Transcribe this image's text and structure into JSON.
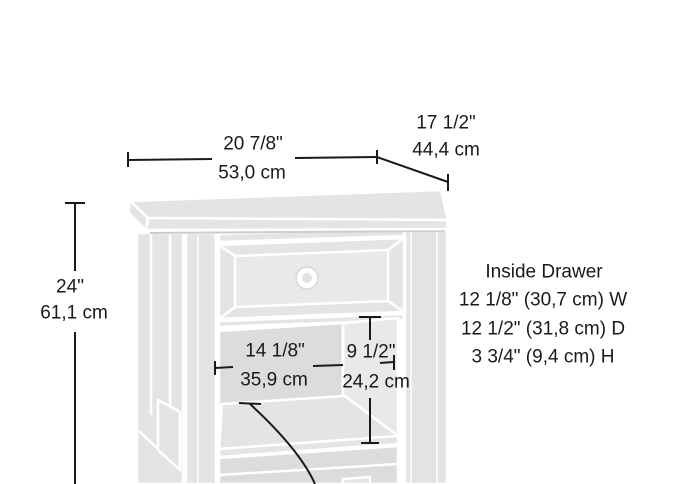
{
  "illustration": {
    "subject": "nightstand line drawing with one drawer and open shelf",
    "colors": {
      "background": "#ffffff",
      "fill": "#e4e4e4",
      "fill_light": "#e9e9e9",
      "fill_shadow": "#dcdcdc",
      "outline": "#ffffff",
      "dimension": "#1a1a1a"
    }
  },
  "dimensions": {
    "width": {
      "imperial": "20 7/8\"",
      "metric": "53,0 cm"
    },
    "depth": {
      "imperial": "17 1/2\"",
      "metric": "44,4 cm"
    },
    "height": {
      "imperial": "24\"",
      "metric": "61,1 cm"
    },
    "shelf_width": {
      "imperial": "14 1/8\"",
      "metric": "35,9 cm"
    },
    "shelf_height": {
      "imperial": "9 1/2\"",
      "metric": "24,2 cm"
    }
  },
  "inside_drawer": {
    "title": "Inside Drawer",
    "lines": [
      "12 1/8\" (30,7 cm) W",
      "12 1/2\" (31,8 cm) D",
      "3 3/4\" (9,4 cm) H"
    ]
  }
}
